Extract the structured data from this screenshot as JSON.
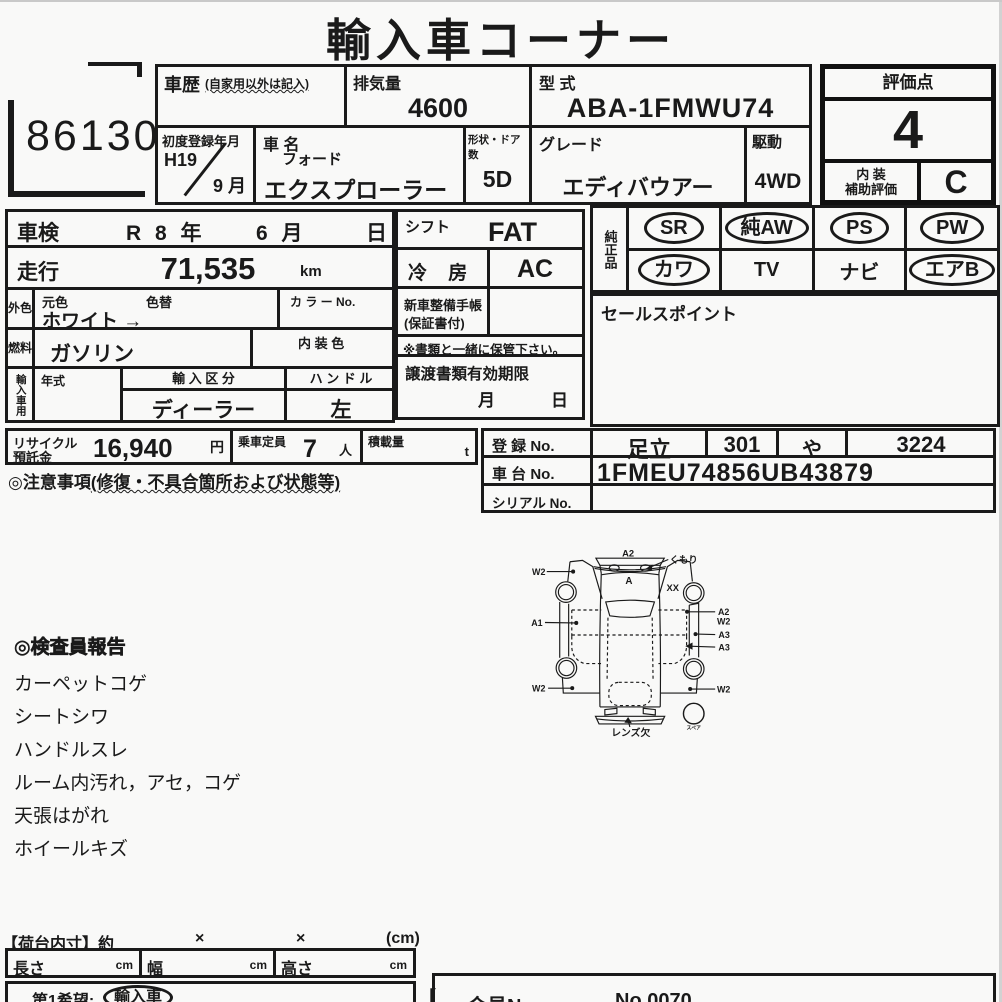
{
  "title": "輸入車コーナー",
  "lot_number": "86130",
  "header": {
    "history_label": "車歴",
    "history_note": "(自家用以外は記入)",
    "displacement_label": "排気量",
    "displacement_value": "4600",
    "model_code_label": "型 式",
    "model_code_value": "ABA-1FMWU74",
    "first_reg_label": "初度登録年月",
    "first_reg_year": "H19",
    "first_reg_month": "9 月",
    "car_name_label": "車 名",
    "car_maker": "フォード",
    "car_name": "エクスプローラー",
    "doors_label": "形状・ドア数",
    "doors_value": "5D",
    "grade_label": "グレード",
    "grade_value": "エディバウアー",
    "drive_label": "駆動",
    "drive_value": "4WD"
  },
  "rating": {
    "label": "評価点",
    "score": "4",
    "interior_label_1": "内 装",
    "interior_label_2": "補助評価",
    "interior_score": "C"
  },
  "left_table": {
    "shaken_label": "車検",
    "shaken_year": "R 8 年",
    "shaken_month": "6 月",
    "shaken_day": "日",
    "mileage_label": "走行",
    "mileage_value": "71,535",
    "mileage_unit": "km",
    "ext_color_label": "外色",
    "orig_color_label": "元色",
    "color_change_label": "色替",
    "color_value": "ホワイト →",
    "color_no_label": "カ ラ ー No.",
    "fuel_label": "燃料",
    "fuel_value": "ガソリン",
    "int_color_label": "内 装 色",
    "import_label": "輸入車用",
    "year_type_label": "年式",
    "import_class_label": "輸 入 区 分",
    "import_class_value": "ディーラー",
    "handle_label": "ハ ン ド ル",
    "handle_value": "左"
  },
  "middle": {
    "shift_label": "シフト",
    "shift_value": "FAT",
    "ac_label": "冷 房",
    "ac_value": "AC",
    "service_book_label_1": "新車整備手帳",
    "service_book_label_2": "(保証書付)",
    "keep_note": "※書類と一緒に保管下さい。",
    "transfer_label": "譲渡書類有効期限",
    "transfer_month": "月",
    "transfer_day": "日"
  },
  "equipment": {
    "group_label": "純正品",
    "row1": [
      {
        "label": "SR",
        "circled": true
      },
      {
        "label": "純AW",
        "circled": true
      },
      {
        "label": "PS",
        "circled": true
      },
      {
        "label": "PW",
        "circled": true
      }
    ],
    "row2": [
      {
        "label": "カワ",
        "circled": true
      },
      {
        "label": "TV",
        "circled": false
      },
      {
        "label": "ナビ",
        "circled": false
      },
      {
        "label": "エアB",
        "circled": true
      }
    ]
  },
  "sales_point_label": "セールスポイント",
  "recycle": {
    "label_1": "リサイクル",
    "label_2": "預託金",
    "value": "16,940",
    "unit": "円"
  },
  "capacity": {
    "label": "乗車定員",
    "value": "7",
    "unit": "人"
  },
  "load": {
    "label": "積載量",
    "unit": "t"
  },
  "caution_label": "◎注意事項",
  "caution_note": "(修復・不具合箇所および状態等)",
  "registration": {
    "reg_no_label": "登 録 No.",
    "reg_area": "足立",
    "reg_class": "301",
    "reg_kana": "や",
    "reg_number": "3224",
    "chassis_label": "車 台 No.",
    "chassis_value": "1FMEU74856UB43879",
    "serial_label": "シリアル No."
  },
  "inspector_report": {
    "heading": "◎検査員報告",
    "items": [
      "カーペットコゲ",
      "シートシワ",
      "ハンドルスレ",
      "ルーム内汚れ，アセ，コゲ",
      "天張はがれ",
      "ホイールキズ"
    ]
  },
  "diagram": {
    "labels": {
      "front_top": "A2",
      "fog": "くもり",
      "w2_left_top": "W2",
      "hood": "A",
      "xx": "XX",
      "a1": "A1",
      "a2_right": "A2",
      "w2_right_top": "W2",
      "a3_right_1": "A3",
      "a3_right_2": "A3",
      "w2_left_bottom": "W2",
      "w2_right_bottom": "W2",
      "lens": "レンズ欠",
      "spare": "スペア"
    }
  },
  "bed_size": {
    "label": "【荷台内寸】約",
    "x1": "×",
    "x2": "×",
    "unit": "(cm)",
    "length_label": "長さ",
    "width_label": "幅",
    "height_label": "高さ",
    "cm": "cm"
  },
  "first_choice": {
    "label": "第1希望:",
    "value": "輸入車",
    "bracket": "【"
  },
  "member": {
    "label": "会員No.",
    "value": "No.0070"
  }
}
